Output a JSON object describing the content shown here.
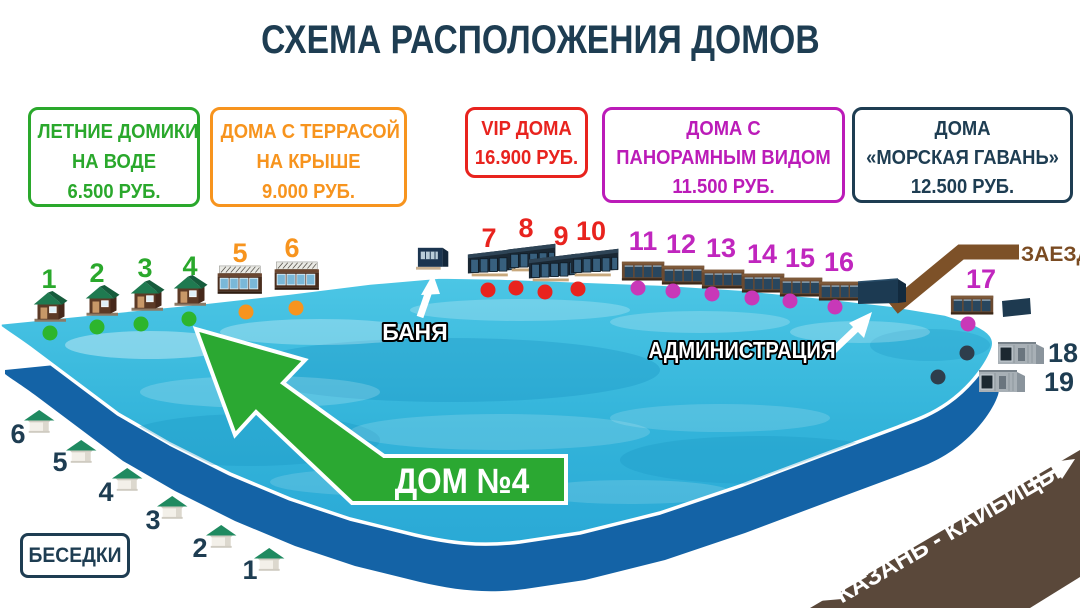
{
  "title": "СХЕМА РАСПОЛОЖЕНИЯ ДОМОВ",
  "legend": [
    {
      "name": "summer-houses-on-water",
      "lines": [
        "ЛЕТНИЕ ДОМИКИ",
        "НА ВОДЕ",
        "6.500 РУБ."
      ],
      "color": "#2aa82c"
    },
    {
      "name": "roof-terrace-houses",
      "lines": [
        "ДОМА С ТЕРРАСОЙ",
        "НА КРЫШЕ",
        "9.000 РУБ."
      ],
      "color": "#f7941e"
    },
    {
      "name": "vip-houses",
      "lines": [
        "VIP ДОМА",
        "16.900 РУБ."
      ],
      "color": "#e8231e"
    },
    {
      "name": "panoramic-view-houses",
      "lines": [
        "ДОМА С",
        "ПАНОРАМНЫМ ВИДОМ",
        "11.500 РУБ."
      ],
      "color": "#bb1bb8"
    },
    {
      "name": "sea-harbor-houses",
      "lines": [
        "ДОМА",
        "«МОРСКАЯ ГАВАНЬ»",
        "12.500 РУБ."
      ],
      "color": "#1e3d52"
    }
  ],
  "map": {
    "houses": [
      {
        "number": "1",
        "category": "summer"
      },
      {
        "number": "2",
        "category": "summer"
      },
      {
        "number": "3",
        "category": "summer"
      },
      {
        "number": "4",
        "category": "summer"
      },
      {
        "number": "5",
        "category": "terrace"
      },
      {
        "number": "6",
        "category": "terrace"
      },
      {
        "number": "7",
        "category": "vip"
      },
      {
        "number": "8",
        "category": "vip"
      },
      {
        "number": "9",
        "category": "vip"
      },
      {
        "number": "10",
        "category": "vip"
      },
      {
        "number": "11",
        "category": "panoramic"
      },
      {
        "number": "12",
        "category": "panoramic"
      },
      {
        "number": "13",
        "category": "panoramic"
      },
      {
        "number": "14",
        "category": "panoramic"
      },
      {
        "number": "15",
        "category": "panoramic"
      },
      {
        "number": "16",
        "category": "panoramic"
      },
      {
        "number": "17",
        "category": "panoramic"
      },
      {
        "number": "18",
        "category": "harbor"
      },
      {
        "number": "19",
        "category": "harbor"
      }
    ],
    "gazebo_numbers": [
      "1",
      "2",
      "3",
      "4",
      "5",
      "6"
    ],
    "labels": {
      "banya": "БАНЯ",
      "administration": "АДМИНИСТРАЦИЯ",
      "entrance": "ЗАЕЗД",
      "house4_callout": "ДОМ №4",
      "gazebos": "БЕСЕДКИ",
      "road_line1": "ДОРОГА",
      "road_line2": "КАЗАНЬ - КАЙБИЦЫ"
    },
    "colors": {
      "title_navy": "#1e3d52",
      "water": "#3bbede",
      "pond_side": "#1463a6",
      "summer_green": "#2aa82c",
      "terrace_orange": "#f7941e",
      "vip_red": "#e8231e",
      "panoramic_magenta": "#c026be",
      "harbor_navy": "#1e3d52",
      "entrance_road_brown": "#7d5128",
      "main_road_brown": "#5a483a",
      "callout_green": "#2ba832"
    }
  }
}
